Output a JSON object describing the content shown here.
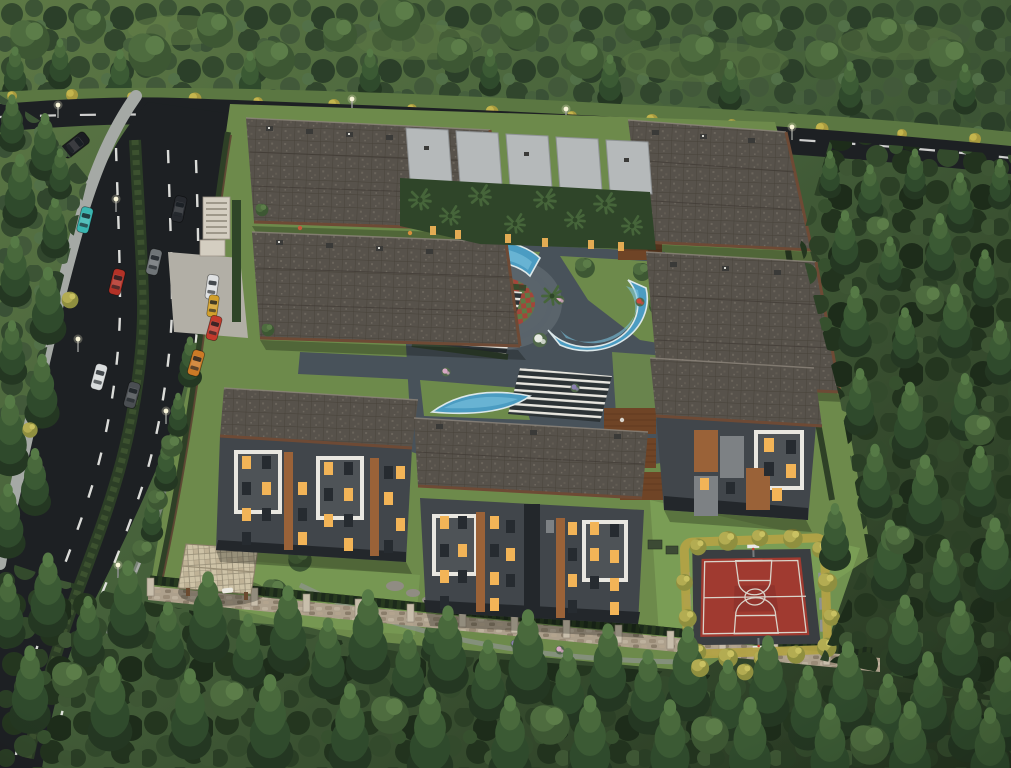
{
  "scene": {
    "type": "aerial-architectural-render",
    "subject": "residential complex with landscaped courtyard surrounded by pine forest",
    "time_of_day": "dusk, apartment windows lit",
    "viewpoint": "high oblique aerial"
  },
  "palette": {
    "road": "#1d2023",
    "road_line": "#efefec",
    "sidewalk": "#a5a9a5",
    "median_hedge": "#2c3e26",
    "lawn": "#6d8a4b",
    "lawn_light": "#7da057",
    "forest_base_light": "#4c663c",
    "forest_base_dark": "#243520",
    "roof_base": "#57524b",
    "roof_trim": "#6e4a35",
    "villa_roof": "#b5b9ba",
    "facade": "#41464b",
    "facade_dark": "#23272b",
    "balcony_white": "#e9e7e0",
    "wood_accent": "#9a6238",
    "window_lit": "#f2b457",
    "window_dark": "#262b30",
    "paved": "#48525a",
    "paved_light": "#5a646b",
    "pool_water": "#4b9cc2",
    "pool_hi": "#7cc3dd",
    "pool_rim": "#dce8ea",
    "court_red": "#a03a30",
    "court_line": "#d9d3c9",
    "court_border": "#3a3e41",
    "hedge_yellow": "#b2a246",
    "deck_wood": "#6f4426",
    "stone_wall": "#ada08c",
    "stone_light": "#c8beab",
    "pergola_tile": "#cdc2a6",
    "mat_red": "#a2463a",
    "mat_green": "#5d7a45"
  },
  "cars": [
    {
      "name": "black-suv",
      "color": "#1b1d21"
    },
    {
      "name": "teal-car",
      "color": "#3ab5b0"
    },
    {
      "name": "dark-sedan",
      "color": "#26292e"
    },
    {
      "name": "gray-sedan",
      "color": "#6f7477"
    },
    {
      "name": "red-car",
      "color": "#b33227"
    },
    {
      "name": "white-car-gate",
      "color": "#dfe1e2"
    },
    {
      "name": "yellow-taxi",
      "color": "#d2a02c"
    },
    {
      "name": "red-car-edge",
      "color": "#c23a2c"
    },
    {
      "name": "orange-sportscar",
      "color": "#cc7a26"
    },
    {
      "name": "white-sedan",
      "color": "#d9dcdd"
    },
    {
      "name": "graphite-sedan",
      "color": "#4a4e52"
    }
  ],
  "objects": {
    "buildings": [
      "north-west-block-a",
      "north-west-block-b",
      "north-east-block",
      "east-block",
      "villa-row-with-palm-garden",
      "west-apartment",
      "center-apartment",
      "east-apartment"
    ],
    "amenities": [
      "curved-swimming-pool-north",
      "curved-swimming-pool-east",
      "curved-swimming-pool-south",
      "children-playground",
      "seating-pergola-terraces",
      "basketball-court",
      "garden-gazebo",
      "wooden-lounge-decks",
      "stone-perimeter-wall",
      "entrance-gate"
    ],
    "roads": [
      "top-road",
      "curved-avenue-with-hedge-median",
      "entrance-driveway"
    ]
  }
}
